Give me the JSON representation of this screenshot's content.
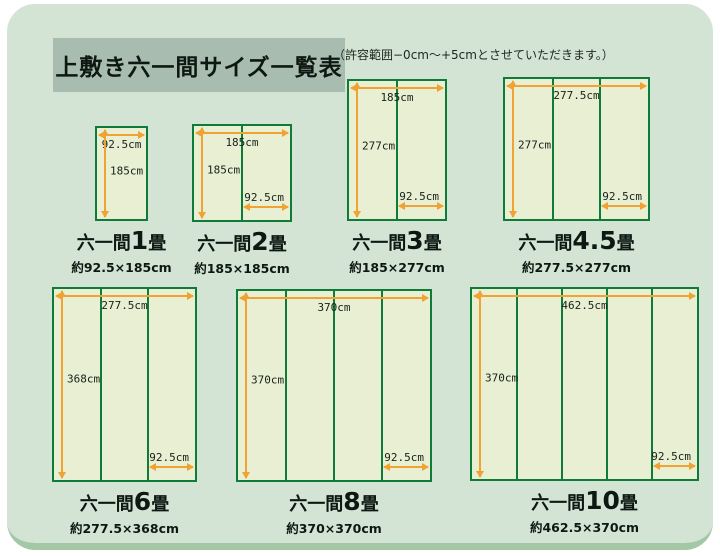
{
  "page": {
    "title": "上敷き六一間サイズ一覧表",
    "note": "（許容範囲−0cm〜+5cmとさせていただきます。）"
  },
  "colors": {
    "panel_bg": "#d3e4d4",
    "panel_rim": "#a4c7a6",
    "title_box_bg": "#a8bdb0",
    "mat_fill": "#e9efd3",
    "mat_border_green": "#0e7c39",
    "dimension_arrow_orange": "#f0a232",
    "text": "#0e1812"
  },
  "diagrams": [
    {
      "name_prefix": "六一間",
      "name_number": "1",
      "name_suffix": "畳",
      "size": "約92.5×185cm",
      "width_label": "92.5cm",
      "height_label": "185cm",
      "unit_label": null,
      "columns": 1
    },
    {
      "name_prefix": "六一間",
      "name_number": "2",
      "name_suffix": "畳",
      "size": "約185×185cm",
      "width_label": "185cm",
      "height_label": "185cm",
      "unit_label": "92.5cm",
      "columns": 2
    },
    {
      "name_prefix": "六一間",
      "name_number": "3",
      "name_suffix": "畳",
      "size": "約185×277cm",
      "width_label": "185cm",
      "height_label": "277cm",
      "unit_label": "92.5cm",
      "columns": 2
    },
    {
      "name_prefix": "六一間",
      "name_number": "4.5",
      "name_suffix": "畳",
      "size": "約277.5×277cm",
      "width_label": "277.5cm",
      "height_label": "277cm",
      "unit_label": "92.5cm",
      "columns": 3
    },
    {
      "name_prefix": "六一間",
      "name_number": "6",
      "name_suffix": "畳",
      "size": "約277.5×368cm",
      "width_label": "277.5cm",
      "height_label": "368cm",
      "unit_label": "92.5cm",
      "columns": 3
    },
    {
      "name_prefix": "六一間",
      "name_number": "8",
      "name_suffix": "畳",
      "size": "約370×370cm",
      "width_label": "370cm",
      "height_label": "370cm",
      "unit_label": "92.5cm",
      "columns": 4
    },
    {
      "name_prefix": "六一間",
      "name_number": "10",
      "name_suffix": "畳",
      "size": "約462.5×370cm",
      "width_label": "462.5cm",
      "height_label": "370cm",
      "unit_label": "92.5cm",
      "columns": 5
    }
  ]
}
